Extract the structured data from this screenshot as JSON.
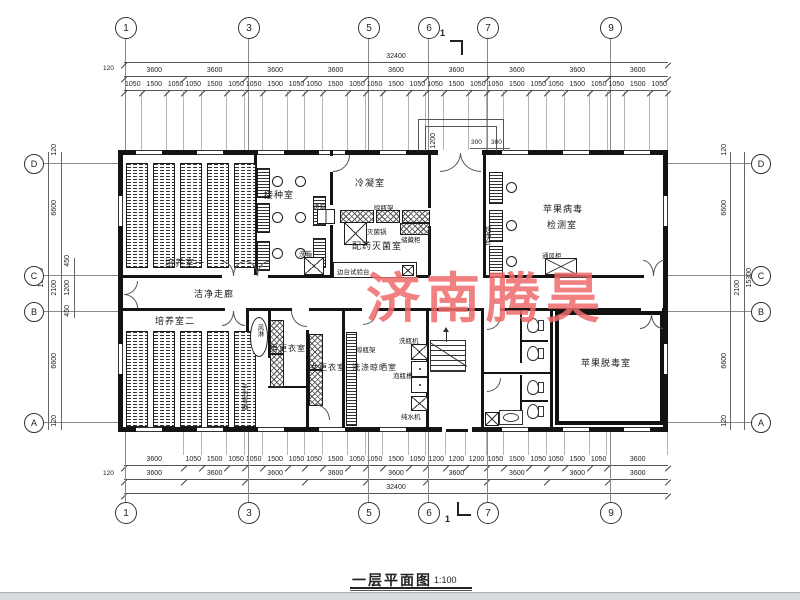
{
  "watermark": {
    "text": "济南腾昊",
    "color": "#ef6a6c"
  },
  "title": {
    "text": "一层平面图",
    "scale": "1:100"
  },
  "section_mark": {
    "label": "1"
  },
  "grid": {
    "cols": [
      "1",
      "3",
      "5",
      "6",
      "7",
      "9"
    ],
    "rows": [
      "D",
      "C",
      "B",
      "A"
    ]
  },
  "dims": {
    "top": {
      "total": "32400",
      "edge": "120",
      "bays": [
        "3600",
        "3600",
        "3600",
        "3600",
        "3600",
        "3600",
        "3600",
        "3600",
        "3600"
      ],
      "detail": [
        "1050",
        "1500",
        "1050",
        "1050",
        "1500",
        "1050",
        "1050",
        "1500",
        "1050",
        "1050",
        "1500",
        "1050",
        "1050",
        "1500",
        "1050",
        "1050",
        "1500",
        "1050",
        "1050",
        "1500",
        "1050",
        "1050",
        "1500",
        "1050",
        "1050",
        "1500",
        "1050"
      ]
    },
    "bottom": {
      "total": "32400",
      "edge": "120",
      "bays": [
        "3600",
        "3600",
        "3600",
        "3600",
        "3600",
        "3600",
        "3600",
        "3600",
        "3600"
      ],
      "detail": [
        "3600",
        "1050",
        "1500",
        "1050",
        "1050",
        "1500",
        "1050",
        "1050",
        "1500",
        "1050",
        "1050",
        "1500",
        "1050",
        "1200",
        "1200",
        "1200",
        "1050",
        "1500",
        "1050",
        "1050",
        "1500",
        "1050",
        "3600"
      ]
    },
    "left": {
      "total": "15300",
      "edge_top": "120",
      "upper": "6600",
      "mid_total": "2100",
      "mid": [
        "450",
        "1200",
        "450"
      ],
      "lower": "6600",
      "edge_bottom": "120"
    },
    "right": {
      "total": "15300",
      "edge_top": "120",
      "upper": "6600",
      "mid_total": "2100",
      "lower": "6600",
      "edge_bottom": "120"
    },
    "entrance": {
      "depth": "1200",
      "w1": "300",
      "w2": "300"
    }
  },
  "rooms": {
    "culture1": "培养室一",
    "inoculation": "接种室",
    "condensing": "冷凝室",
    "prep_sterilize": "配药灭菌室",
    "virus_test_line1": "苹果病毒",
    "virus_test_line2": "检测室",
    "corridor": "洁净走廊",
    "culture2": "培养室二",
    "air_shower": "风淋",
    "men_change": "男更衣室",
    "women_change": "女更衣室",
    "washing": "洗涤晾晒室",
    "detox": "苹果脱毒室"
  },
  "equipment": {
    "pass_box": "递箱",
    "wash_box": "洗箱",
    "bottle_rack": "晾瓶架",
    "sterilizer": "灭菌锅",
    "storage": "储藏柜",
    "side_bench": "边台试验台",
    "clean_bench": "超净台",
    "fume_hood": "通风柜",
    "bottle_washer": "洗瓶机",
    "soak_sink": "泡瓶槽",
    "water_purifier": "纯水机",
    "hand_sanitizer": "手消毒器"
  }
}
